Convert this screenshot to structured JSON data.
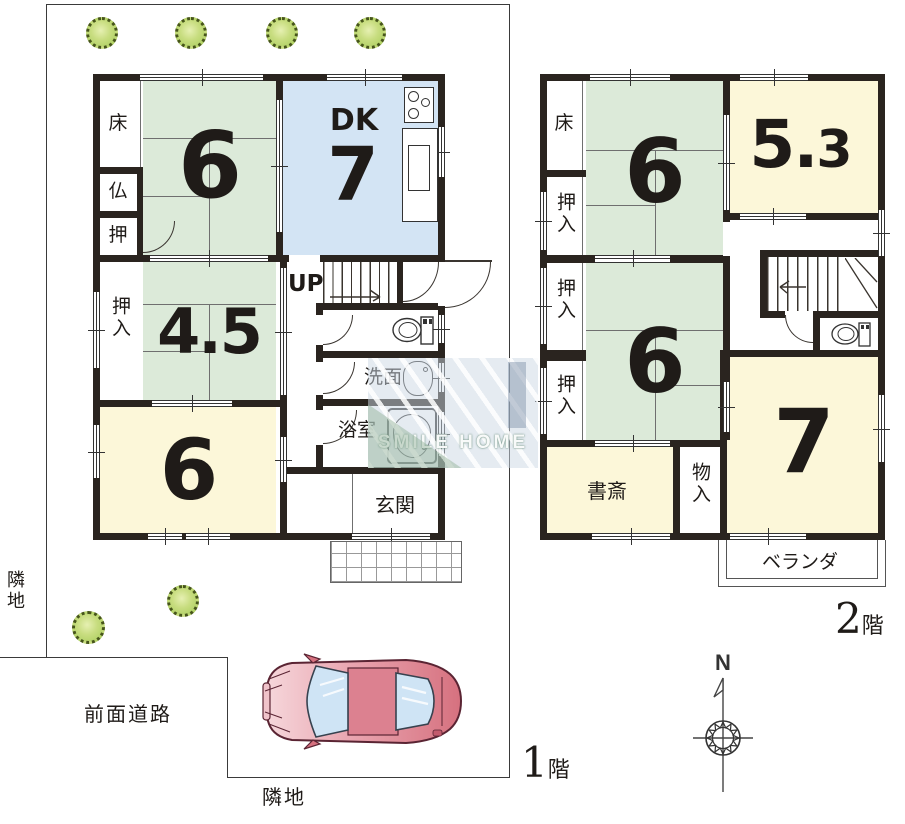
{
  "title": "間取り図",
  "site": {
    "adjacent_left": "隣地",
    "adjacent_bottom": "隣地",
    "front_road": "前面道路"
  },
  "floor1": {
    "label_num": "1",
    "label_kanji": "階",
    "toko": "床",
    "butsudan": "仏",
    "oshi": "押",
    "tatami6_top": "6",
    "dk": "DK",
    "dk_size": "7",
    "oshiire": "押入",
    "tatami45": "4.5",
    "tatami6_bottom": "6",
    "stairs_up": "UP",
    "washroom": "洗面",
    "bathroom": "浴室",
    "entrance": "玄関"
  },
  "floor2": {
    "label_num": "2",
    "label_kanji": "階",
    "toko": "床",
    "oshiire_1": "押入",
    "oshiire_2": "押入",
    "oshiire_3": "押入",
    "tatami6_top": "6",
    "room53": "5.3",
    "tatami6_bottom": "6",
    "study": "書斎",
    "storage": "物入",
    "room7": "7",
    "veranda": "ベランダ"
  },
  "compass": {
    "north": "N"
  },
  "watermark": {
    "text": "SMILE HOME"
  },
  "colors": {
    "wall": "#2a241f",
    "tatami_green": "#dcead9",
    "dk_blue": "#d3e4f4",
    "room_yellow": "#fcf7d9",
    "tree_green": "#b9d76a",
    "car_pink": "#df8595"
  }
}
